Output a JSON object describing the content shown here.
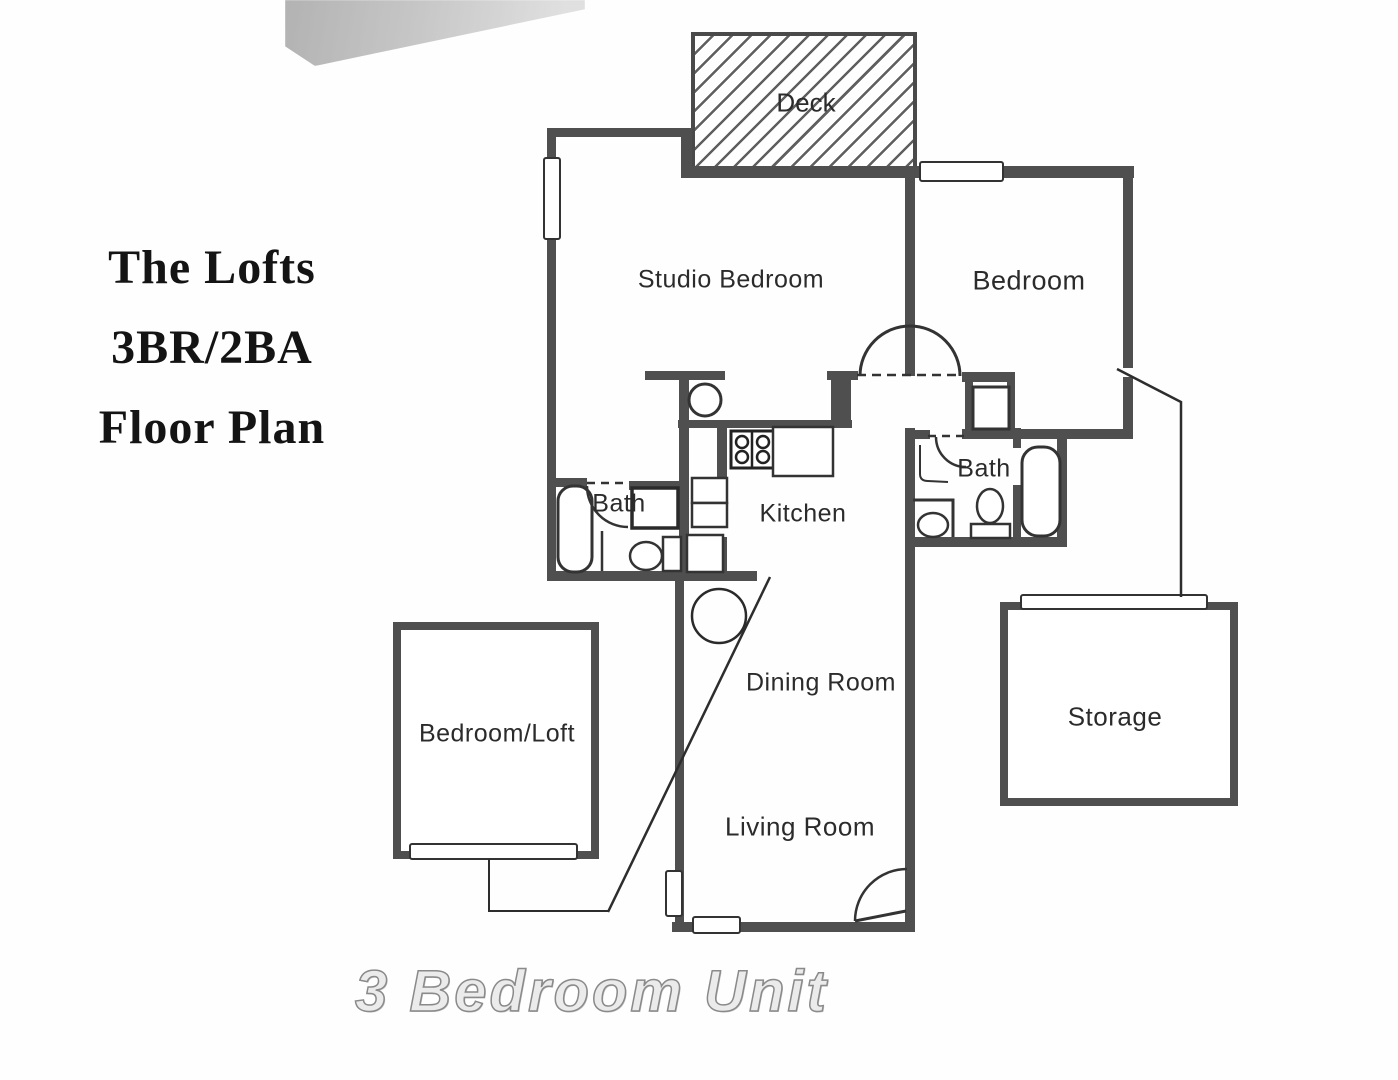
{
  "title": {
    "line1": "The Lofts",
    "line2": "3BR/2BA",
    "line3": "Floor Plan"
  },
  "footer": {
    "caption": "3 Bedroom Unit"
  },
  "rooms": {
    "deck": "Deck",
    "studio_bedroom": "Studio Bedroom",
    "bedroom": "Bedroom",
    "bath_left": "Bath",
    "kitchen": "Kitchen",
    "bath_right": "Bath",
    "dining_room": "Dining Room",
    "living_room": "Living Room",
    "bedroom_loft": "Bedroom/Loft",
    "storage": "Storage"
  },
  "colors": {
    "wall": "#4f4f4f",
    "line": "#333333",
    "label": "#2b2b2b",
    "background": "#ffffff",
    "footer_fill": "#ebebeb",
    "footer_outline": "#8a8a8a"
  }
}
